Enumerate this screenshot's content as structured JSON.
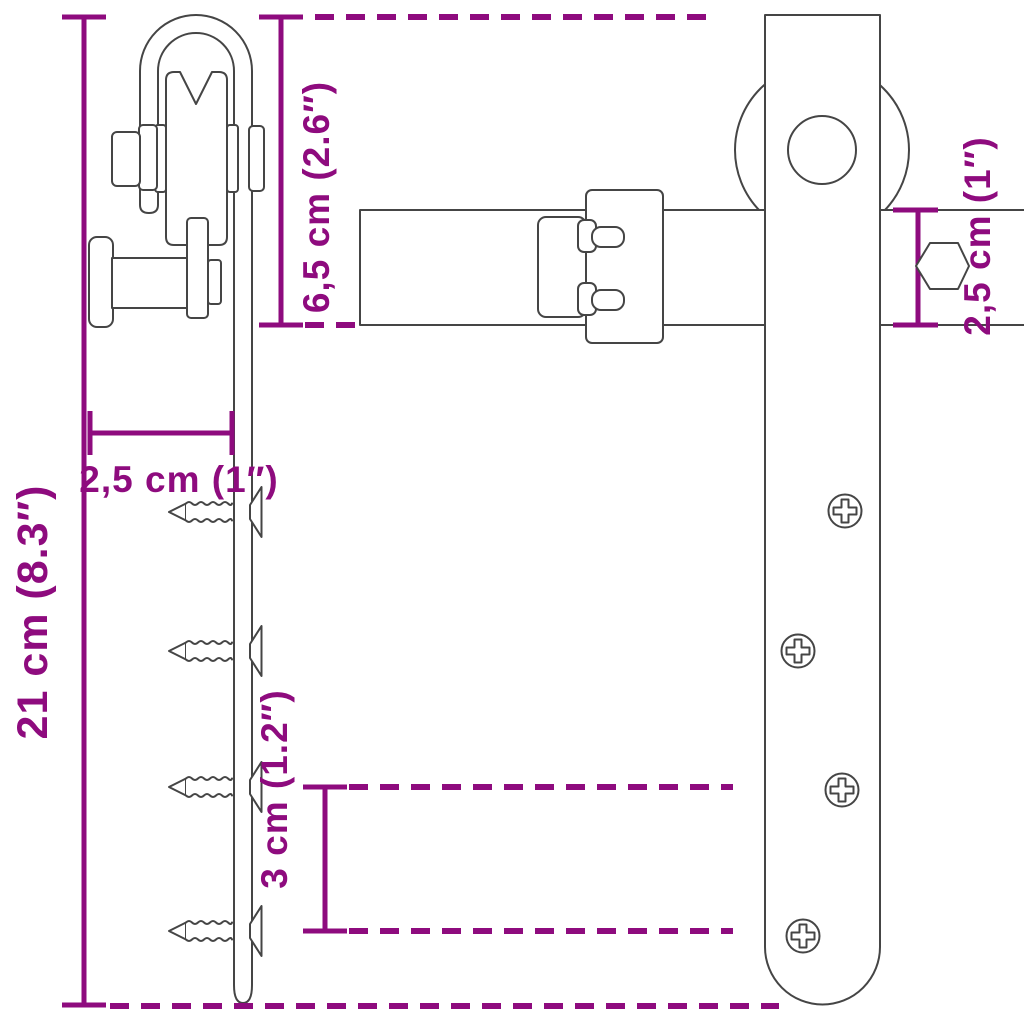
{
  "diagram": {
    "colors": {
      "dimension_accent": "#8E0B7E",
      "outline": "#454545",
      "background": "#FFFFFF"
    },
    "labels": {
      "overall_height": "21 cm (8.3″)",
      "hanger_height": "6,5 cm (2.6″)",
      "offset_width": "2,5 cm (1″)",
      "hole_spacing": "3 cm (1.2″)",
      "rail_height": "2,5 cm (1″)"
    }
  }
}
